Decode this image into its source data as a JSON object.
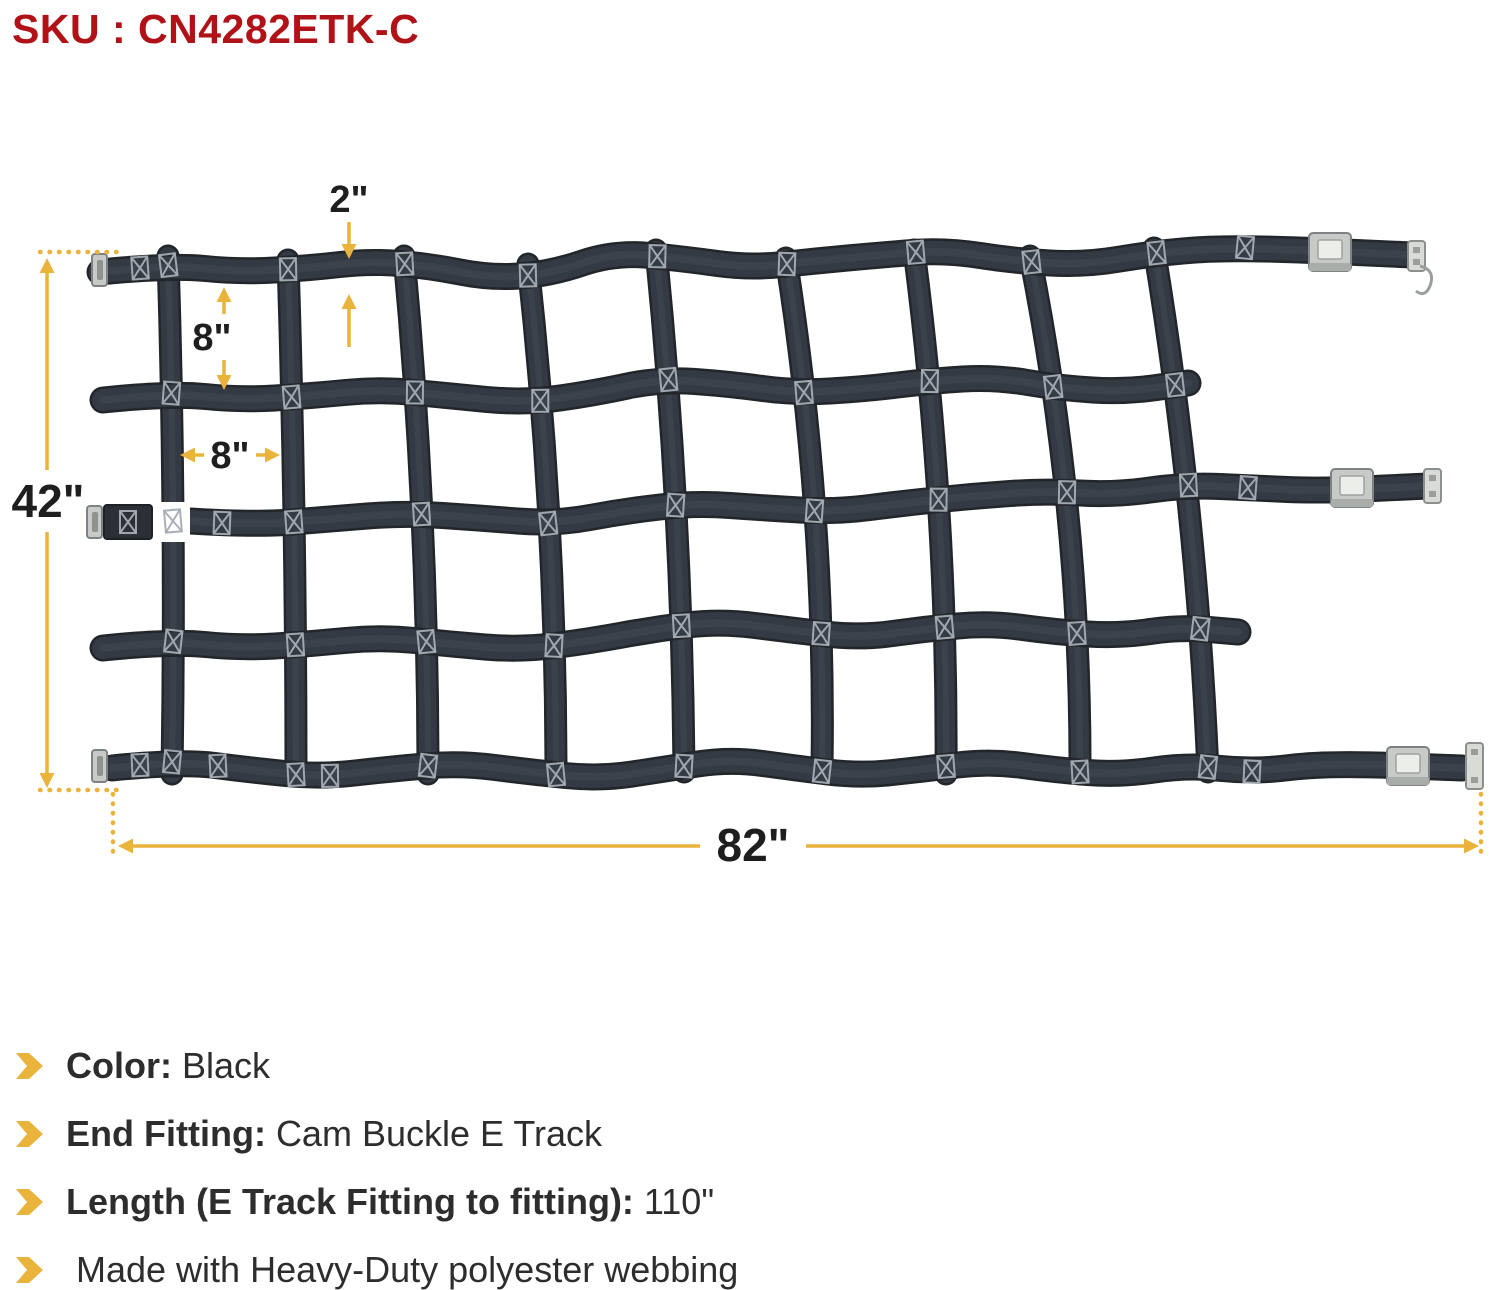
{
  "header": {
    "sku_label": "SKU : CN4282ETK-C"
  },
  "diagram": {
    "dims": {
      "strap_width": "2\"",
      "cell_height": "8\"",
      "cell_width": "8\"",
      "net_height": "42\"",
      "net_width": "82\""
    },
    "colors": {
      "sku_red": "#B01218",
      "dimension_gold": "#EAB33B",
      "webbing_black": "#343A43",
      "text_dark": "#2d2d2d"
    },
    "icon_names": [
      "dimension-arrow-icon",
      "dotted-extension-line",
      "cam-buckle",
      "e-track-fitting",
      "x-stitch"
    ]
  },
  "specs": {
    "items": [
      {
        "label": "Color:",
        "value": "Black"
      },
      {
        "label": "End Fitting:",
        "value": "Cam Buckle E Track"
      },
      {
        "label": "Length (E Track Fitting to fitting):",
        "value": "110\""
      },
      {
        "label": "",
        "value": "Made with Heavy-Duty polyester webbing"
      }
    ]
  }
}
